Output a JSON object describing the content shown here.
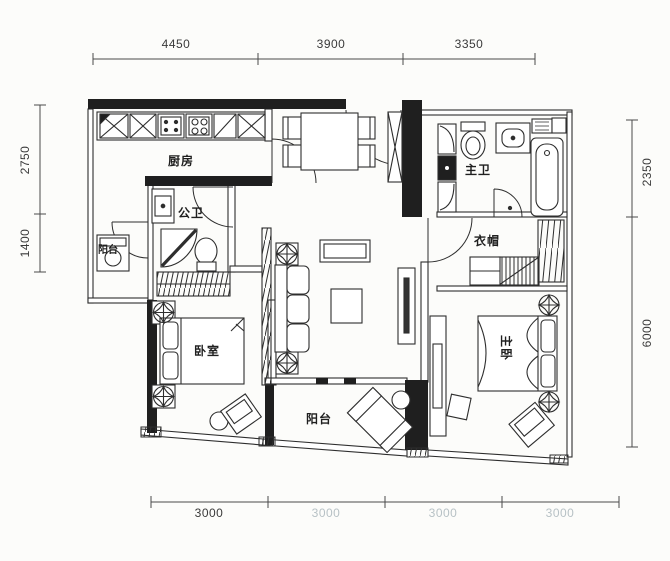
{
  "drawing_type": "apartment-floor-plan",
  "dimensions": {
    "top": [
      "4450",
      "3900",
      "3350"
    ],
    "left": [
      "2750",
      "1400"
    ],
    "right": [
      "2350",
      "6000"
    ],
    "bottom": [
      "3000",
      "3000",
      "3000",
      "3000"
    ]
  },
  "rooms": {
    "kitchen": "厨房",
    "guest_bath": "公卫",
    "balcony_left": "阳台",
    "bedroom": "卧室",
    "balcony_bottom": "阳台",
    "master_bath": "主卫",
    "cloakroom": "衣帽",
    "master_bedroom": "主卧"
  },
  "colors": {
    "wall_fill": "#1f1f1f",
    "line": "#2e2e2e",
    "dim_text": "#3a3a3a",
    "dim_text_faint": "#b7c1c5",
    "paper": "#fcfcfa"
  }
}
